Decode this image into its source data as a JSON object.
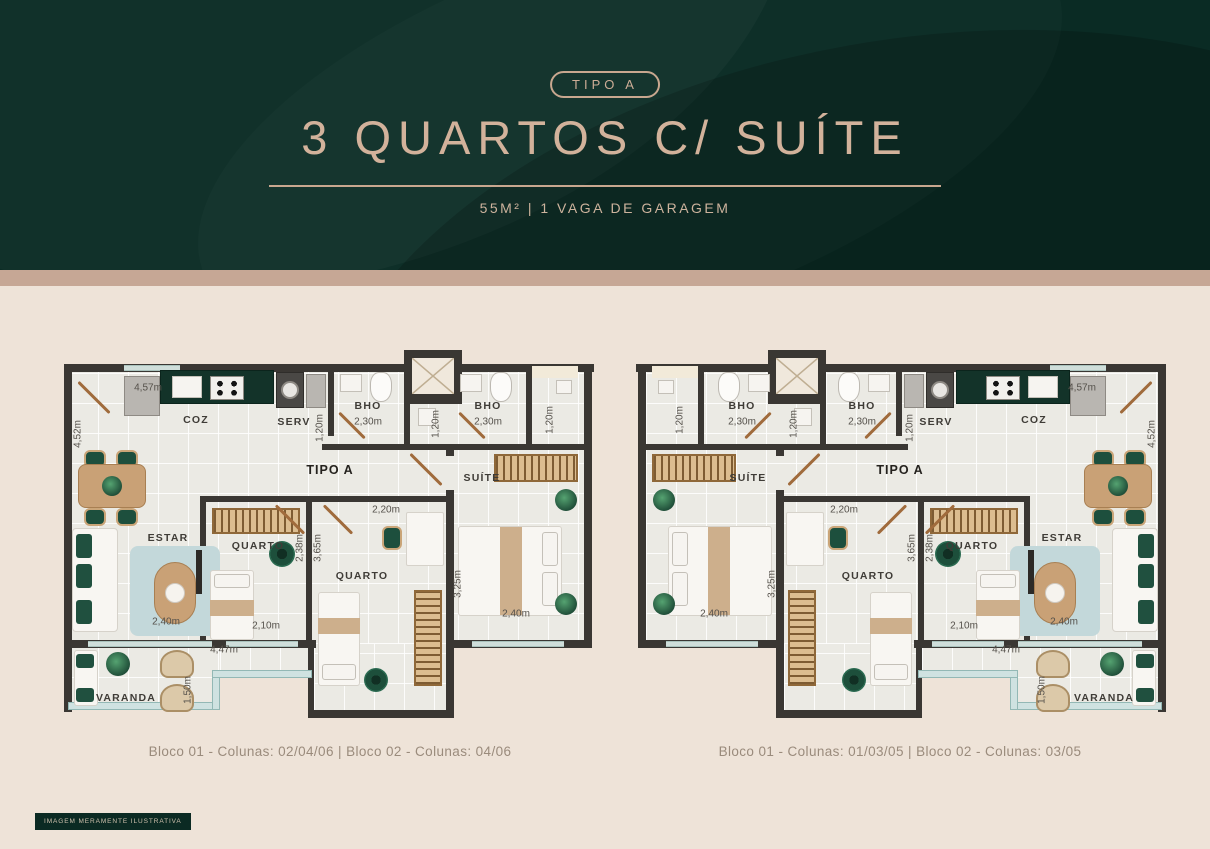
{
  "header": {
    "badge": "TIPO A",
    "title": "3 QUARTOS C/ SUÍTE",
    "subtitle": "55M² | 1 VAGA DE GARAGEM"
  },
  "colors": {
    "header_bg": "#0a2b24",
    "band": "#c6a795",
    "page_bg": "#eee3d8",
    "accent_tan": "#d2b29b",
    "wall": "#3a3733",
    "kitchen_counter": "#133329"
  },
  "plans": [
    {
      "id": "left",
      "mirrored": false,
      "caption": "Bloco 01 - Colunas: 02/04/06 | Bloco 02 - Colunas: 04/06"
    },
    {
      "id": "right",
      "mirrored": true,
      "caption": "Bloco 01 - Colunas: 01/03/05 | Bloco 02 - Colunas: 03/05"
    }
  ],
  "footer": {
    "disclaimer": "IMAGEM MERAMENTE ILUSTRATIVA"
  },
  "plan": {
    "width": 540,
    "height": 375,
    "shapes": [
      {
        "t": "rect",
        "n": "floor-main",
        "c": "floor",
        "x": 8,
        "y": 20,
        "w": 516,
        "h": 274
      },
      {
        "t": "rect",
        "n": "floor-quarto2-ext",
        "c": "floor",
        "x": 254,
        "y": 294,
        "w": 132,
        "h": 70
      },
      {
        "t": "rect",
        "n": "floor-varanda-deep",
        "c": "floor",
        "x": 8,
        "y": 294,
        "w": 152,
        "h": 64
      },
      {
        "t": "rect",
        "n": "floor-varanda-shallow",
        "c": "floor",
        "x": 160,
        "y": 294,
        "w": 88,
        "h": 32
      },
      {
        "t": "rect",
        "n": "wall-top",
        "c": "wall",
        "x": 4,
        "y": 14,
        "w": 530,
        "h": 8
      },
      {
        "t": "rect",
        "n": "wall-left",
        "c": "wall",
        "x": 4,
        "y": 14,
        "w": 8,
        "h": 284
      },
      {
        "t": "rect",
        "n": "wall-right",
        "c": "wall",
        "x": 524,
        "y": 14,
        "w": 8,
        "h": 284
      },
      {
        "t": "rect",
        "n": "wall-bottom-left",
        "c": "wall",
        "x": 4,
        "y": 290,
        "w": 252,
        "h": 8
      },
      {
        "t": "rect",
        "n": "wall-bottom-suite",
        "c": "wall",
        "x": 386,
        "y": 290,
        "w": 146,
        "h": 8
      },
      {
        "t": "rect",
        "n": "wall-varanda-left",
        "c": "wall",
        "x": 4,
        "y": 290,
        "w": 8,
        "h": 72
      },
      {
        "t": "rect",
        "n": "wall-col-left",
        "c": "wall",
        "x": 248,
        "y": 290,
        "w": 6,
        "h": 78
      },
      {
        "t": "rect",
        "n": "wall-col-bottom",
        "c": "wall",
        "x": 248,
        "y": 360,
        "w": 146,
        "h": 8
      },
      {
        "t": "rect",
        "n": "wall-suite-stub",
        "c": "wall",
        "x": 386,
        "y": 94,
        "w": 8,
        "h": 12
      },
      {
        "t": "rect",
        "n": "wall-suite-left",
        "c": "wall",
        "x": 386,
        "y": 140,
        "w": 8,
        "h": 228
      },
      {
        "t": "rect",
        "n": "wall-serv-right",
        "c": "wall",
        "x": 268,
        "y": 16,
        "w": 6,
        "h": 70
      },
      {
        "t": "rect",
        "n": "wall-bho1-right",
        "c": "wall",
        "x": 344,
        "y": 16,
        "w": 6,
        "h": 78
      },
      {
        "t": "rect",
        "n": "wall-bath-row",
        "c": "wall",
        "x": 262,
        "y": 94,
        "w": 132,
        "h": 6
      },
      {
        "t": "rect",
        "n": "wall-bath2-row",
        "c": "wall",
        "x": 394,
        "y": 94,
        "w": 132,
        "h": 6
      },
      {
        "t": "rect",
        "n": "wall-bho2-right",
        "c": "wall",
        "x": 466,
        "y": 16,
        "w": 6,
        "h": 78
      },
      {
        "t": "rect",
        "n": "wall-quartos-top",
        "c": "wall",
        "x": 140,
        "y": 146,
        "w": 252,
        "h": 6
      },
      {
        "t": "rect",
        "n": "wall-quarto1-left",
        "c": "wall",
        "x": 140,
        "y": 146,
        "w": 6,
        "h": 144
      },
      {
        "t": "rect",
        "n": "wall-quarto-divider",
        "c": "wall",
        "x": 246,
        "y": 146,
        "w": 6,
        "h": 144
      },
      {
        "t": "rect",
        "n": "wall-wc-top",
        "c": "wall",
        "x": 344,
        "y": 48,
        "w": 58,
        "h": 6
      },
      {
        "t": "shaft",
        "n": "elevator-shaft",
        "x": 344,
        "y": 0,
        "w": 58,
        "h": 52
      },
      {
        "t": "rect",
        "n": "facade-notch",
        "c": "notch",
        "x": 472,
        "y": 16,
        "w": 46,
        "h": 12
      },
      {
        "t": "rect",
        "n": "glass-wall",
        "c": "glass",
        "x": 8,
        "y": 352,
        "w": 152,
        "h": 8
      },
      {
        "t": "rect",
        "n": "glass-wall",
        "c": "glass",
        "x": 152,
        "y": 320,
        "w": 8,
        "h": 40
      },
      {
        "t": "rect",
        "n": "glass-wall",
        "c": "glass",
        "x": 152,
        "y": 320,
        "w": 100,
        "h": 8
      },
      {
        "t": "rect",
        "n": "window-sill",
        "c": "sill",
        "x": 28,
        "y": 291,
        "w": 124,
        "h": 6
      },
      {
        "t": "rect",
        "n": "window-sill",
        "c": "sill",
        "x": 166,
        "y": 291,
        "w": 72,
        "h": 6
      },
      {
        "t": "rect",
        "n": "window-sill",
        "c": "sill",
        "x": 412,
        "y": 291,
        "w": 92,
        "h": 6
      },
      {
        "t": "rect",
        "n": "window-sill",
        "c": "sill",
        "x": 64,
        "y": 15,
        "w": 56,
        "h": 6
      },
      {
        "t": "rect",
        "n": "fridge",
        "c": "appl",
        "x": 64,
        "y": 26,
        "w": 36,
        "h": 40
      },
      {
        "t": "rect",
        "n": "kitchen-counter",
        "c": "counter",
        "x": 100,
        "y": 20,
        "w": 114,
        "h": 34
      },
      {
        "t": "rect",
        "n": "kitchen-sink",
        "c": "white-box",
        "x": 112,
        "y": 26,
        "w": 30,
        "h": 22
      },
      {
        "t": "rect",
        "n": "stove",
        "c": "stove",
        "x": 150,
        "y": 26,
        "w": 34,
        "h": 24
      },
      {
        "t": "rect",
        "n": "washer",
        "c": "appl-dark",
        "x": 216,
        "y": 22,
        "w": 28,
        "h": 36
      },
      {
        "t": "circle",
        "n": "washer-drum",
        "c": "drum",
        "cx": 230,
        "cy": 40,
        "d": 18
      },
      {
        "t": "rect",
        "n": "laundry-tub",
        "c": "appl",
        "x": 246,
        "y": 24,
        "w": 20,
        "h": 34
      },
      {
        "t": "rect",
        "n": "bathroom-sink",
        "c": "white-box",
        "x": 280,
        "y": 24,
        "w": 22,
        "h": 18
      },
      {
        "t": "rect",
        "n": "toilet",
        "c": "toilet",
        "x": 310,
        "y": 22,
        "w": 22,
        "h": 30
      },
      {
        "t": "rect",
        "n": "shower",
        "c": "white-box",
        "x": 358,
        "y": 58,
        "w": 18,
        "h": 18
      },
      {
        "t": "rect",
        "n": "bathroom-sink",
        "c": "white-box",
        "x": 400,
        "y": 24,
        "w": 22,
        "h": 18
      },
      {
        "t": "rect",
        "n": "toilet",
        "c": "toilet",
        "x": 430,
        "y": 22,
        "w": 22,
        "h": 30
      },
      {
        "t": "rect",
        "n": "wc-sink",
        "c": "white-box",
        "x": 496,
        "y": 30,
        "w": 16,
        "h": 14
      },
      {
        "t": "rect",
        "n": "dining-chair",
        "c": "chair",
        "x": 24,
        "y": 100,
        "w": 22,
        "h": 18
      },
      {
        "t": "rect",
        "n": "dining-chair",
        "c": "chair",
        "x": 56,
        "y": 100,
        "w": 22,
        "h": 18
      },
      {
        "t": "rect",
        "n": "dining-chair",
        "c": "chair",
        "x": 24,
        "y": 158,
        "w": 22,
        "h": 18
      },
      {
        "t": "rect",
        "n": "dining-chair",
        "c": "chair",
        "x": 56,
        "y": 158,
        "w": 22,
        "h": 18
      },
      {
        "t": "rect",
        "n": "dining-table",
        "c": "wood",
        "x": 18,
        "y": 114,
        "w": 68,
        "h": 44,
        "r": 8
      },
      {
        "t": "circle",
        "n": "centerpiece-plant",
        "c": "plant",
        "cx": 52,
        "cy": 136,
        "d": 20
      },
      {
        "t": "rect",
        "n": "sofa",
        "c": "white",
        "x": 12,
        "y": 178,
        "w": 46,
        "h": 104,
        "r": 4
      },
      {
        "t": "rect",
        "n": "sofa-pillow",
        "c": "gpillow",
        "x": 16,
        "y": 184,
        "w": 16,
        "h": 24
      },
      {
        "t": "rect",
        "n": "sofa-pillow",
        "c": "gpillow",
        "x": 16,
        "y": 214,
        "w": 16,
        "h": 24
      },
      {
        "t": "rect",
        "n": "sofa-pillow",
        "c": "gpillow",
        "x": 16,
        "y": 250,
        "w": 16,
        "h": 24
      },
      {
        "t": "rect",
        "n": "area-rug",
        "c": "rug",
        "x": 70,
        "y": 196,
        "w": 90,
        "h": 90
      },
      {
        "t": "rect",
        "n": "coffee-table",
        "c": "wood",
        "x": 94,
        "y": 212,
        "w": 42,
        "h": 62,
        "r": 21
      },
      {
        "t": "circle",
        "n": "coffee-tray",
        "c": "white-circle",
        "cx": 115,
        "cy": 243,
        "d": 20
      },
      {
        "t": "rect",
        "n": "tv",
        "c": "dark",
        "x": 136,
        "y": 200,
        "w": 6,
        "h": 44
      },
      {
        "t": "rect",
        "n": "wardrobe",
        "c": "wardrobe-h",
        "x": 152,
        "y": 158,
        "w": 88,
        "h": 26
      },
      {
        "t": "rect",
        "n": "bed-single",
        "c": "white",
        "x": 150,
        "y": 220,
        "w": 44,
        "h": 70,
        "r": 3
      },
      {
        "t": "rect",
        "n": "bed-pillow",
        "c": "white-box",
        "x": 154,
        "y": 224,
        "w": 36,
        "h": 14,
        "r": 3
      },
      {
        "t": "rect",
        "n": "bed-throw",
        "c": "tan",
        "x": 150,
        "y": 250,
        "w": 44,
        "h": 16
      },
      {
        "t": "circle",
        "n": "round-rug",
        "c": "green-rug",
        "cx": 222,
        "cy": 204,
        "d": 26
      },
      {
        "t": "rect",
        "n": "desk",
        "c": "white",
        "x": 346,
        "y": 162,
        "w": 38,
        "h": 54,
        "r": 2
      },
      {
        "t": "rect",
        "n": "desk-chair",
        "c": "chair",
        "x": 322,
        "y": 176,
        "w": 20,
        "h": 24
      },
      {
        "t": "rect",
        "n": "wardrobe",
        "c": "wardrobe-v",
        "x": 354,
        "y": 240,
        "w": 28,
        "h": 96
      },
      {
        "t": "rect",
        "n": "bed-single",
        "c": "white",
        "x": 258,
        "y": 242,
        "w": 42,
        "h": 94,
        "r": 3
      },
      {
        "t": "rect",
        "n": "bed-throw",
        "c": "tan",
        "x": 258,
        "y": 268,
        "w": 42,
        "h": 16
      },
      {
        "t": "rect",
        "n": "bed-pillow",
        "c": "white-box",
        "x": 262,
        "y": 314,
        "w": 34,
        "h": 16,
        "r": 3
      },
      {
        "t": "circle",
        "n": "round-rug",
        "c": "green-rug",
        "cx": 316,
        "cy": 330,
        "d": 24
      },
      {
        "t": "rect",
        "n": "wardrobe",
        "c": "wardrobe-h",
        "x": 434,
        "y": 104,
        "w": 84,
        "h": 28
      },
      {
        "t": "rect",
        "n": "bed-double",
        "c": "white",
        "x": 398,
        "y": 176,
        "w": 104,
        "h": 90,
        "r": 3
      },
      {
        "t": "rect",
        "n": "bed-throw",
        "c": "tan",
        "x": 440,
        "y": 177,
        "w": 22,
        "h": 88
      },
      {
        "t": "rect",
        "n": "bed-pillow",
        "c": "white-box",
        "x": 482,
        "y": 182,
        "w": 16,
        "h": 34,
        "r": 3
      },
      {
        "t": "rect",
        "n": "bed-pillow",
        "c": "white-box",
        "x": 482,
        "y": 222,
        "w": 16,
        "h": 34,
        "r": 3
      },
      {
        "t": "circle",
        "n": "plant",
        "c": "plant",
        "cx": 506,
        "cy": 150,
        "d": 22
      },
      {
        "t": "circle",
        "n": "plant",
        "c": "plant",
        "cx": 506,
        "cy": 254,
        "d": 22
      },
      {
        "t": "rect",
        "n": "outdoor-sofa",
        "c": "white",
        "x": 14,
        "y": 300,
        "w": 24,
        "h": 56,
        "r": 3
      },
      {
        "t": "rect",
        "n": "sofa-pillow",
        "c": "gpillow",
        "x": 16,
        "y": 304,
        "w": 18,
        "h": 14
      },
      {
        "t": "rect",
        "n": "sofa-pillow",
        "c": "gpillow",
        "x": 16,
        "y": 338,
        "w": 18,
        "h": 14
      },
      {
        "t": "circle",
        "n": "plant",
        "c": "plant",
        "cx": 58,
        "cy": 314,
        "d": 24
      },
      {
        "t": "rect",
        "n": "rattan-chair",
        "c": "rattan",
        "x": 100,
        "y": 300,
        "w": 34,
        "h": 28
      },
      {
        "t": "rect",
        "n": "rattan-chair",
        "c": "rattan",
        "x": 100,
        "y": 334,
        "w": 34,
        "h": 28
      }
    ],
    "doors": [
      {
        "n": "entry-door-swing",
        "cx": 34,
        "cy": 46,
        "len": 44,
        "rot": 45
      },
      {
        "n": "bho-door-swing",
        "cx": 292,
        "cy": 74,
        "len": 36,
        "rot": 45
      },
      {
        "n": "bho-door-swing",
        "cx": 412,
        "cy": 74,
        "len": 36,
        "rot": 45
      },
      {
        "n": "suite-door-swing",
        "cx": 366,
        "cy": 118,
        "len": 44,
        "rot": 45
      },
      {
        "n": "quarto-door-swing",
        "cx": 230,
        "cy": 168,
        "len": 40,
        "rot": 45
      },
      {
        "n": "quarto-door-swing",
        "cx": 278,
        "cy": 168,
        "len": 40,
        "rot": 45
      }
    ],
    "labels": [
      {
        "text": "4,57m",
        "cls": "meas",
        "cx": 88,
        "cy": 38
      },
      {
        "text": "4,52m",
        "cls": "meas",
        "cx": 18,
        "cy": 84,
        "rot": -90
      },
      {
        "text": "COZ",
        "cls": "room",
        "cx": 136,
        "cy": 70
      },
      {
        "text": "SERV",
        "cls": "room",
        "cx": 234,
        "cy": 72
      },
      {
        "text": "1,20m",
        "cls": "meas",
        "cx": 260,
        "cy": 78,
        "rot": -90
      },
      {
        "text": "BHO",
        "cls": "room",
        "cx": 308,
        "cy": 56
      },
      {
        "text": "2,30m",
        "cls": "meas",
        "cx": 308,
        "cy": 72
      },
      {
        "text": "1,20m",
        "cls": "meas",
        "cx": 376,
        "cy": 74,
        "rot": -90
      },
      {
        "text": "BHO",
        "cls": "room",
        "cx": 428,
        "cy": 56
      },
      {
        "text": "2,30m",
        "cls": "meas",
        "cx": 428,
        "cy": 72
      },
      {
        "text": "1,20m",
        "cls": "meas",
        "cx": 490,
        "cy": 70,
        "rot": -90
      },
      {
        "text": "TIPO A",
        "cls": "plan",
        "cx": 270,
        "cy": 120
      },
      {
        "text": "SUÍTE",
        "cls": "room",
        "cx": 422,
        "cy": 128
      },
      {
        "text": "2,20m",
        "cls": "meas",
        "cx": 326,
        "cy": 160
      },
      {
        "text": "3,25m",
        "cls": "meas",
        "cx": 398,
        "cy": 234,
        "rot": -90
      },
      {
        "text": "2,40m",
        "cls": "meas",
        "cx": 456,
        "cy": 264
      },
      {
        "text": "QUARTO",
        "cls": "room",
        "cx": 198,
        "cy": 196
      },
      {
        "text": "2,38m",
        "cls": "meas",
        "cx": 240,
        "cy": 198,
        "rot": -90
      },
      {
        "text": "3,65m",
        "cls": "meas",
        "cx": 258,
        "cy": 198,
        "rot": -90
      },
      {
        "text": "2,10m",
        "cls": "meas",
        "cx": 206,
        "cy": 276
      },
      {
        "text": "QUARTO",
        "cls": "room",
        "cx": 302,
        "cy": 226
      },
      {
        "text": "ESTAR",
        "cls": "room",
        "cx": 108,
        "cy": 188
      },
      {
        "text": "2,40m",
        "cls": "meas",
        "cx": 106,
        "cy": 272
      },
      {
        "text": "4,47m",
        "cls": "meas",
        "cx": 164,
        "cy": 300
      },
      {
        "text": "1,50m",
        "cls": "meas",
        "cx": 128,
        "cy": 340,
        "rot": -90
      },
      {
        "text": "VARANDA",
        "cls": "room",
        "cx": 66,
        "cy": 348
      }
    ]
  }
}
